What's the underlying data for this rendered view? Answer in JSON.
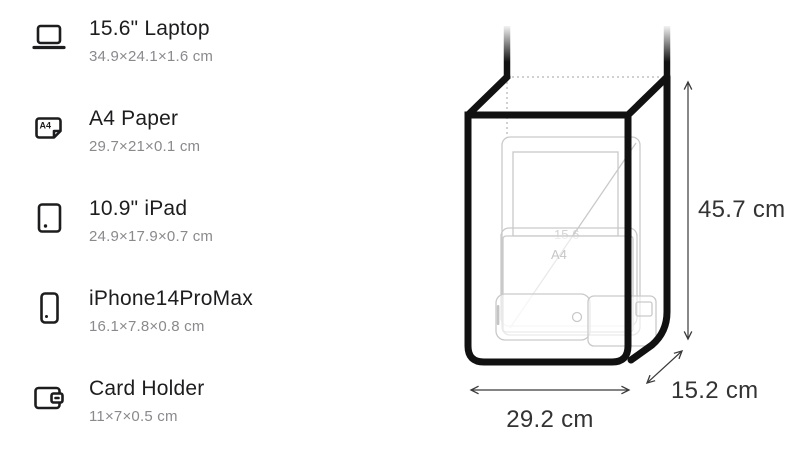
{
  "items": [
    {
      "name": "15.6\" Laptop",
      "dims": "34.9×24.1×1.6 cm",
      "icon": "laptop-icon"
    },
    {
      "name": "A4 Paper",
      "dims": "29.7×21×0.1 cm",
      "icon": "a4-paper-icon",
      "icon_text": "A4"
    },
    {
      "name": "10.9\" iPad",
      "dims": "24.9×17.9×0.7 cm",
      "icon": "ipad-icon"
    },
    {
      "name": "iPhone14ProMax",
      "dims": "16.1×7.8×0.8 cm",
      "icon": "iphone-icon"
    },
    {
      "name": "Card Holder",
      "dims": "11×7×0.5 cm",
      "icon": "card-holder-icon"
    }
  ],
  "bag": {
    "height_label": "45.7 cm",
    "width_label": "29.2 cm",
    "depth_label": "15.2 cm",
    "ghost_labels": {
      "laptop": "15.6",
      "paper": "A4"
    }
  },
  "colors": {
    "outline": "#111111",
    "title_text": "#1d1d1f",
    "dims_text": "#8a8a8e",
    "dimension_label": "#333333",
    "ghost": "#c9c9c9"
  }
}
